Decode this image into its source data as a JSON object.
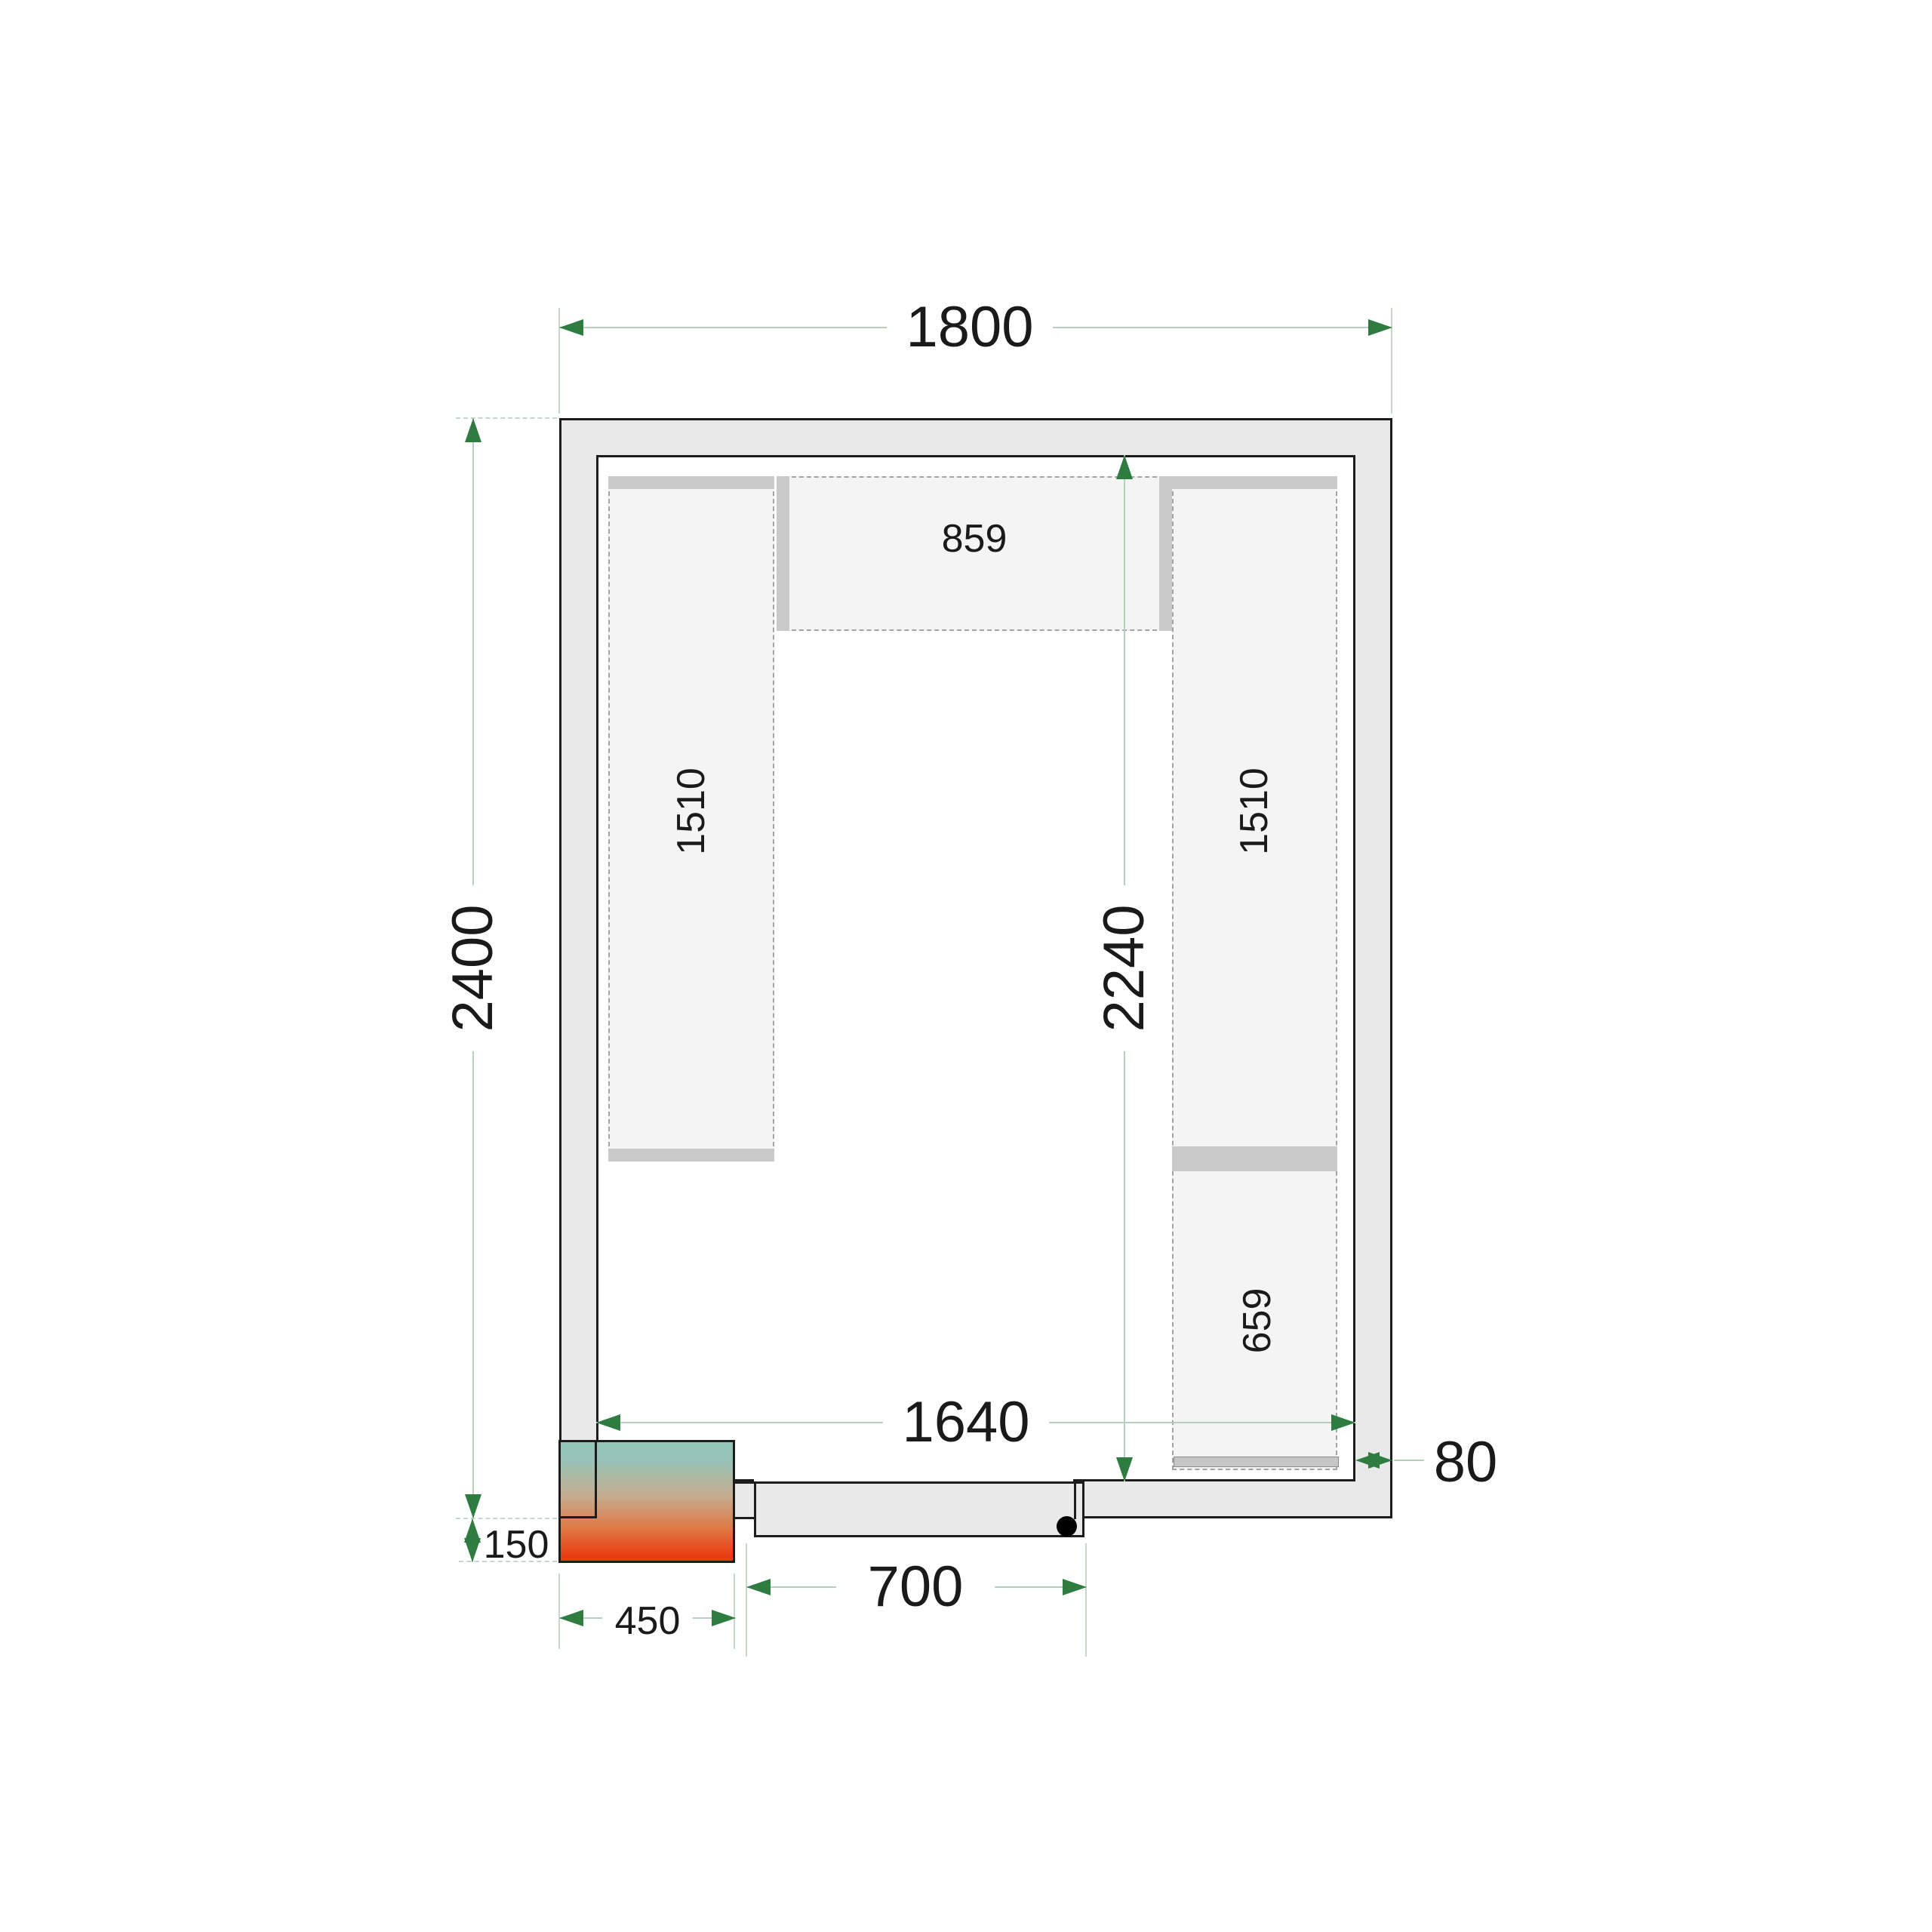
{
  "title": "Cold room floor plan drawing",
  "dimensions": {
    "outer_width": "1800",
    "outer_height": "2400",
    "interior_width": "1640",
    "interior_height": "2240",
    "wall_thickness": "80",
    "cooling_unit_offset": "150",
    "cooling_unit_width": "450",
    "door_width": "700"
  },
  "shelves": {
    "left_length": "1510",
    "top_length": "859",
    "right_upper_length": "1510",
    "right_lower_length": "659"
  },
  "colors": {
    "wall_fill": "#e9e9e9",
    "outline": "#1c1c1c",
    "shelf_fill": "#f4f4f4",
    "shelf_dash": "#a3a3a3",
    "bar_fill": "#c9c9c9",
    "door_fill": "#e9e9e9",
    "dim_line": "#b7cebc",
    "ext_line": "#c4d7c8",
    "dim_arrow": "#2e7c3f",
    "text": "#1a1a1a",
    "cooler_top": "#96c3b8",
    "cooler_mid": "#c4ad90",
    "cooler_orange": "#df7a48",
    "cooler_red": "#e83c11"
  }
}
